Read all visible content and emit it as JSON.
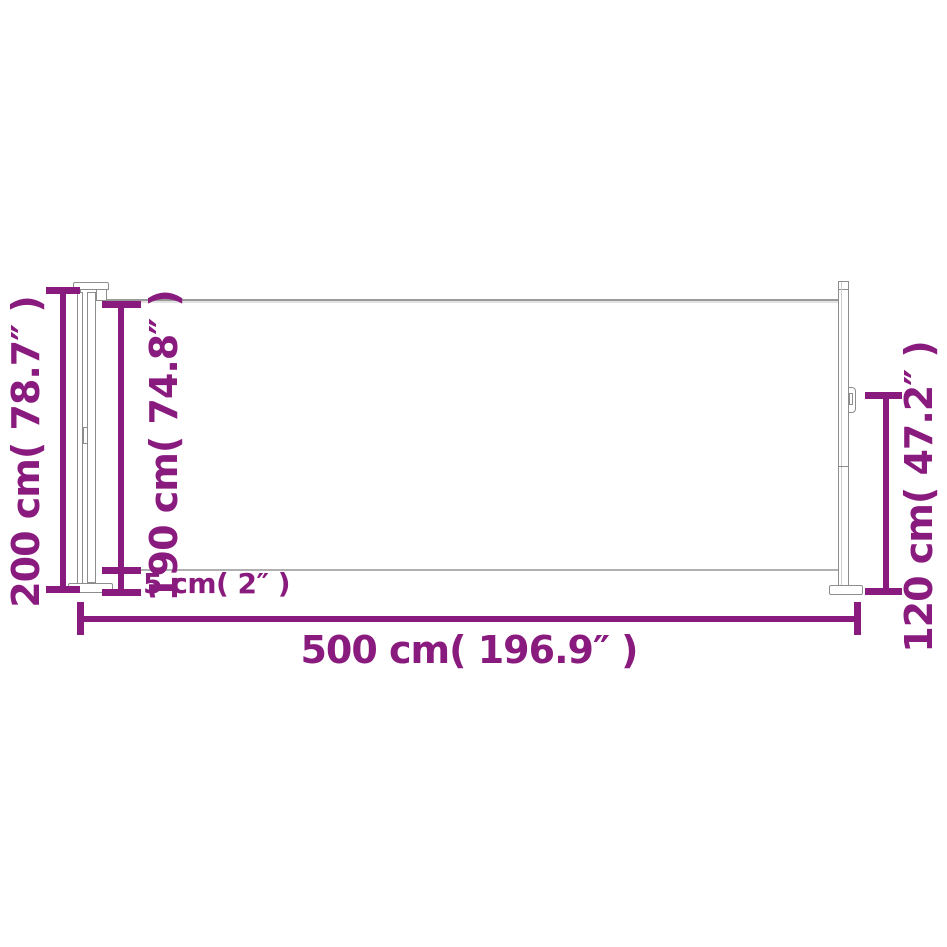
{
  "diagram": {
    "subject": "retractable side awning side-view dimension drawing",
    "accent_color": "#8A1B7E",
    "outline_color": "#8d8d8d",
    "dimensions": {
      "total_height": "200 cm( 78.7″ )",
      "canopy_height": "190 cm( 74.8″ )",
      "ground_clearance": "5 cm( 2″ )",
      "total_length": "500 cm( 196.9″ )",
      "post_height": "120 cm( 47.2″ )"
    }
  }
}
